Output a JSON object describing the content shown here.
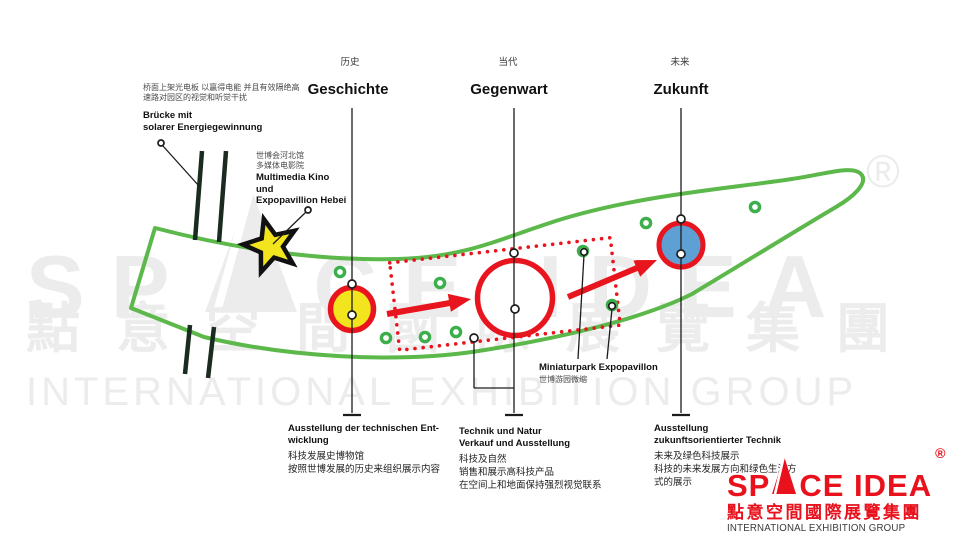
{
  "timeline": {
    "stages": [
      {
        "zh": "历史",
        "de": "Geschichte"
      },
      {
        "zh": "当代",
        "de": "Gegenwart"
      },
      {
        "zh": "未来",
        "de": "Zukunft"
      }
    ]
  },
  "annotations": {
    "bruecke": {
      "zh1": "桥面上架光电板 以赢得电能 并且有效隔绝高",
      "zh2": "速路对园区的视觉和听觉干扰",
      "de1": "Brücke mit",
      "de2": "solarer Energiegewinnung"
    },
    "multimedia": {
      "zh1": "世博会河北馆",
      "zh2": "多媒体电影院",
      "de1": "Multimedia Kino",
      "de2": "und",
      "de3": "Expopavillion Hebei"
    },
    "miniaturpark": {
      "de": "Miniaturpark Expopavillon",
      "zh": "世博游园微缩"
    }
  },
  "blocks": {
    "history": {
      "de1": "Ausstellung der technischen Ent-",
      "de2": "wicklung",
      "zh1": "科技发展史博物馆",
      "zh2": "按照世博发展的历史来组织展示内容"
    },
    "present": {
      "de1": "Technik und Natur",
      "de2": "Verkauf und Ausstellung",
      "zh1": "科技及自然",
      "zh2": "销售和展示高科技产品",
      "zh3": "在空间上和地面保持强烈视觉联系"
    },
    "future": {
      "de1": "Ausstellung",
      "de2": "zukunftsorientierter Technik",
      "zh1": "未来及绿色科技展示",
      "zh2": "科技的未来发展方向和绿色生活方",
      "zh3": "式的展示"
    }
  },
  "watermark": {
    "row1_left": "SP",
    "row1_right": "CE IDEA",
    "reg": "®",
    "row2": "點意空間國際展覽集團",
    "row3": "INTERNATIONAL EXHIBITION GROUP"
  },
  "logo": {
    "left": "SP",
    "right": "CE IDEA",
    "reg": "®",
    "cn": "點意空間國際展覽集團",
    "en": "INTERNATIONAL EXHIBITION GROUP"
  },
  "colors": {
    "outline_green": "#5cb84a",
    "accent_red": "#e8151e",
    "node_yellow": "#f2e41d",
    "node_blue": "#5e9fd4",
    "dot_green": "#3cae4b",
    "bridge_dark": "#1a2b20",
    "logo_red": "#e8111c",
    "watermark_gray": "#ececec"
  }
}
